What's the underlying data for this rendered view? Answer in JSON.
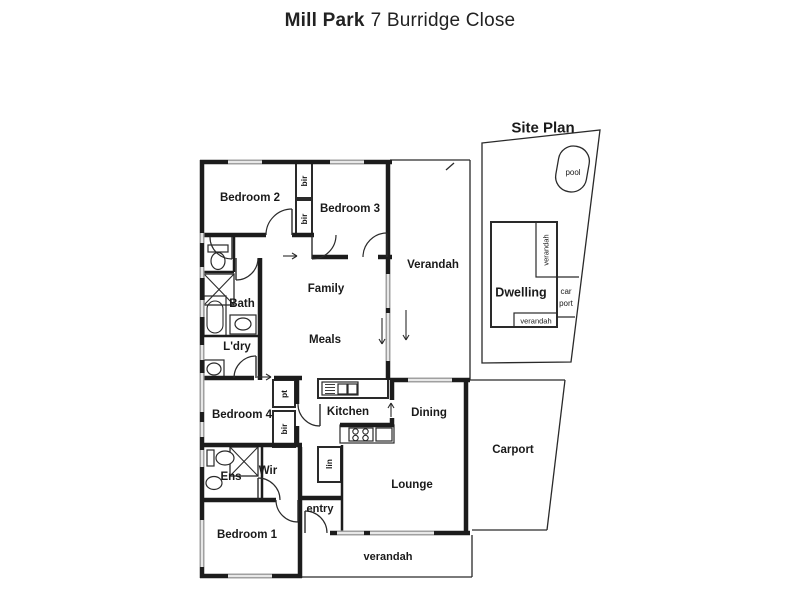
{
  "title": {
    "property": "Mill Park",
    "address": "7 Burridge Close"
  },
  "colors": {
    "wall": "#1c1c1c",
    "thin": "#2a2a2a",
    "window_glass": "#a0a0a0",
    "text": "#1a1a1a",
    "background": "#ffffff"
  },
  "floor_plan": {
    "room_labels": [
      {
        "t": "Bedroom 2",
        "x": 250,
        "y": 197,
        "s": 11.5,
        "w": 700
      },
      {
        "t": "Bedroom 3",
        "x": 350,
        "y": 208,
        "s": 11.5,
        "w": 700
      },
      {
        "t": "Verandah",
        "x": 433,
        "y": 264,
        "s": 11.5,
        "w": 700
      },
      {
        "t": "Family",
        "x": 326,
        "y": 288,
        "s": 11.5,
        "w": 700
      },
      {
        "t": "Meals",
        "x": 325,
        "y": 339,
        "s": 11.5,
        "w": 700
      },
      {
        "t": "Bath",
        "x": 242,
        "y": 303,
        "s": 11.5,
        "w": 700
      },
      {
        "t": "L'dry",
        "x": 237,
        "y": 346,
        "s": 11.5,
        "w": 700
      },
      {
        "t": "Bedroom 4",
        "x": 242,
        "y": 414,
        "s": 11.5,
        "w": 700
      },
      {
        "t": "Kitchen",
        "x": 348,
        "y": 411,
        "s": 11.5,
        "w": 700
      },
      {
        "t": "Dining",
        "x": 429,
        "y": 412,
        "s": 11.5,
        "w": 700
      },
      {
        "t": "Lounge",
        "x": 412,
        "y": 484,
        "s": 11.5,
        "w": 700
      },
      {
        "t": "Ens",
        "x": 231,
        "y": 476,
        "s": 11.5,
        "w": 700
      },
      {
        "t": "Wir",
        "x": 268,
        "y": 470,
        "s": 11.5,
        "w": 700
      },
      {
        "t": "Bedroom 1",
        "x": 247,
        "y": 534,
        "s": 11.5,
        "w": 700
      },
      {
        "t": "entry",
        "x": 320,
        "y": 508,
        "s": 11,
        "w": 700
      },
      {
        "t": "verandah",
        "x": 388,
        "y": 556,
        "s": 11,
        "w": 700
      },
      {
        "t": "Carport",
        "x": 513,
        "y": 449,
        "s": 11.5,
        "w": 700
      }
    ],
    "closet_labels": [
      {
        "t": "bir",
        "x": 304,
        "y": 181,
        "s": 8.5,
        "w": 700,
        "r": -90
      },
      {
        "t": "bir",
        "x": 304,
        "y": 219,
        "s": 8.5,
        "w": 700,
        "r": -90
      },
      {
        "t": "pt",
        "x": 284,
        "y": 394,
        "s": 8.5,
        "w": 700,
        "r": -90
      },
      {
        "t": "bir",
        "x": 284,
        "y": 429,
        "s": 8.5,
        "w": 700,
        "r": -90
      },
      {
        "t": "lin",
        "x": 329,
        "y": 464,
        "s": 8.5,
        "w": 700,
        "r": -90
      }
    ]
  },
  "site_plan": {
    "labels": [
      {
        "t": "Site Plan",
        "x": 543,
        "y": 127,
        "s": 15,
        "w": 700
      },
      {
        "t": "pool",
        "x": 573,
        "y": 172,
        "s": 8,
        "w": 400
      },
      {
        "t": "Dwelling",
        "x": 521,
        "y": 292,
        "s": 12.5,
        "w": 700
      },
      {
        "t": "verandah",
        "x": 546,
        "y": 250,
        "s": 7.5,
        "w": 400,
        "r": -90
      },
      {
        "t": "car",
        "x": 566,
        "y": 291,
        "s": 8,
        "w": 400
      },
      {
        "t": "port",
        "x": 566,
        "y": 303,
        "s": 8,
        "w": 400
      },
      {
        "t": "verandah",
        "x": 536,
        "y": 321,
        "s": 7.5,
        "w": 400
      }
    ],
    "boundary": [
      [
        482,
        143
      ],
      [
        600,
        130
      ],
      [
        571,
        362
      ],
      [
        482,
        363
      ]
    ],
    "dwelling_rect": [
      491,
      222,
      66,
      105
    ],
    "verandah_strip_right": [
      536,
      222,
      21,
      55
    ],
    "verandah_strip_bottom": [
      514,
      313,
      43,
      14
    ],
    "carport_lines": [
      [
        557,
        277,
        579,
        277
      ],
      [
        557,
        317,
        575,
        317
      ]
    ],
    "pool_shape": {
      "x": 557,
      "y": 146,
      "w": 31,
      "h": 46,
      "rx": 15,
      "rotate": 10
    }
  },
  "drawing": {
    "walls_thick": [
      [
        200,
        162,
        392,
        162
      ],
      [
        202,
        160,
        202,
        578
      ],
      [
        388,
        162,
        388,
        380
      ],
      [
        200,
        576,
        302,
        576
      ],
      [
        300,
        447,
        300,
        578
      ],
      [
        202,
        235,
        266,
        235
      ],
      [
        292,
        235,
        314,
        235
      ],
      [
        312,
        257,
        348,
        257
      ],
      [
        378,
        257,
        392,
        257
      ],
      [
        260,
        258,
        260,
        380
      ],
      [
        202,
        378,
        254,
        378
      ],
      [
        274,
        378,
        302,
        378
      ],
      [
        202,
        445,
        302,
        445
      ],
      [
        202,
        500,
        276,
        500
      ],
      [
        330,
        533,
        470,
        533
      ],
      [
        390,
        380,
        470,
        380
      ],
      [
        466,
        378,
        466,
        535
      ],
      [
        392,
        380,
        392,
        400
      ],
      [
        392,
        418,
        392,
        426
      ],
      [
        340,
        425,
        394,
        425
      ],
      [
        297,
        378,
        297,
        404
      ],
      [
        297,
        426,
        297,
        447
      ],
      [
        300,
        498,
        343,
        498
      ]
    ],
    "walls_medium": [
      [
        234,
        235,
        234,
        272
      ],
      [
        202,
        272,
        234,
        272
      ],
      [
        202,
        336,
        258,
        336
      ],
      [
        262,
        445,
        262,
        500
      ],
      [
        342,
        445,
        342,
        533
      ]
    ],
    "walls_thin": [
      [
        390,
        160,
        470,
        160
      ],
      [
        470,
        160,
        470,
        380
      ],
      [
        302,
        577,
        472,
        577
      ],
      [
        472,
        535,
        472,
        577
      ],
      [
        470,
        380,
        565,
        380
      ],
      [
        565,
        380,
        547,
        530
      ],
      [
        547,
        530,
        472,
        530
      ],
      [
        446,
        170,
        454,
        163
      ]
    ],
    "windows": [
      [
        228,
        162,
        262,
        162
      ],
      [
        330,
        162,
        364,
        162
      ],
      [
        202,
        233,
        202,
        243
      ],
      [
        202,
        267,
        202,
        278
      ],
      [
        202,
        300,
        202,
        317
      ],
      [
        202,
        345,
        202,
        360
      ],
      [
        202,
        373,
        202,
        412
      ],
      [
        202,
        422,
        202,
        437
      ],
      [
        202,
        450,
        202,
        467
      ],
      [
        202,
        520,
        202,
        567
      ],
      [
        228,
        576,
        272,
        576
      ],
      [
        337,
        533,
        364,
        533
      ],
      [
        370,
        533,
        434,
        533
      ],
      [
        388,
        274,
        388,
        308
      ],
      [
        388,
        313,
        388,
        361
      ],
      [
        408,
        380,
        452,
        380
      ]
    ],
    "boxes": [
      {
        "n": "bir-closet-1",
        "r": [
          296,
          163,
          16,
          35
        ],
        "sw": 2
      },
      {
        "n": "bir-closet-2",
        "r": [
          296,
          200,
          16,
          35
        ],
        "sw": 2
      },
      {
        "n": "pantry-closet",
        "r": [
          273,
          380,
          22,
          27
        ],
        "sw": 2
      },
      {
        "n": "bir-closet-3",
        "r": [
          273,
          411,
          22,
          36
        ],
        "sw": 2
      },
      {
        "n": "linen-closet",
        "r": [
          318,
          447,
          23,
          35
        ],
        "sw": 2
      },
      {
        "n": "kitchen-island",
        "r": [
          318,
          379,
          70,
          19
        ],
        "sw": 2
      },
      {
        "n": "kitchen-sink-unit",
        "r": [
          322,
          382,
          36,
          13
        ],
        "sw": 1.2
      },
      {
        "n": "sink-bowl-1",
        "r": [
          338,
          384,
          9,
          10
        ],
        "sw": 1.2
      },
      {
        "n": "sink-bowl-2",
        "r": [
          348,
          384,
          9,
          10
        ],
        "sw": 1.2
      },
      {
        "n": "cooktop-counter",
        "r": [
          340,
          425,
          54,
          18
        ],
        "sw": 1.2
      },
      {
        "n": "cooktop-box",
        "r": [
          349,
          428,
          24,
          13
        ],
        "sw": 1.2
      },
      {
        "n": "counter-box",
        "r": [
          376,
          428,
          16,
          13
        ],
        "sw": 1.2
      },
      {
        "n": "wc-cistern",
        "r": [
          208,
          245,
          20,
          7
        ],
        "sw": 1.2
      },
      {
        "n": "bath-vanity",
        "r": [
          230,
          315,
          26,
          19
        ],
        "sw": 1.2
      },
      {
        "n": "laundry-trough",
        "r": [
          204,
          360,
          20,
          18
        ],
        "sw": 1.2
      },
      {
        "n": "ens-cistern",
        "r": [
          207,
          450,
          7,
          16
        ],
        "sw": 1.2
      },
      {
        "n": "bathtub-outer",
        "r": [
          204,
          296,
          22,
          40
        ],
        "sw": 1.2
      }
    ],
    "rrects": [
      {
        "n": "bathtub-inner",
        "r": [
          207,
          301,
          16,
          32
        ],
        "rx": 8,
        "sw": 1.1
      }
    ],
    "xboxes": [
      {
        "n": "shower-bath",
        "r": [
          204,
          274,
          30,
          31
        ]
      },
      {
        "n": "shower-ens",
        "r": [
          230,
          447,
          28,
          29
        ]
      }
    ],
    "ellipses": [
      {
        "n": "wc-toilet-bowl",
        "c": [
          218,
          261,
          7,
          8.5
        ]
      },
      {
        "n": "vanity-basin",
        "c": [
          243,
          324,
          8,
          6
        ]
      },
      {
        "n": "trough-basin",
        "c": [
          214,
          369,
          7,
          6
        ]
      },
      {
        "n": "ens-toilet-bowl",
        "c": [
          225,
          458,
          9,
          7
        ]
      },
      {
        "n": "ens-basin",
        "c": [
          214,
          483,
          8,
          6.5
        ]
      }
    ],
    "cooktop_circles": [
      [
        355.5,
        431.5
      ],
      [
        365.5,
        431.5
      ],
      [
        355.5,
        438
      ],
      [
        365.5,
        438
      ]
    ],
    "hatch_lines": [
      [
        325,
        384.5,
        335,
        384.5
      ],
      [
        325,
        387.5,
        335,
        387.5
      ],
      [
        325,
        390.5,
        335,
        390.5
      ],
      [
        325,
        393.5,
        335,
        393.5
      ]
    ],
    "doors": [
      {
        "n": "door-bedroom2",
        "p": "M266,235 A26,26 0 0 1 292,209",
        "l": [
          292,
          235,
          292,
          209
        ]
      },
      {
        "n": "door-bedroom3",
        "p": "M363,257 A24,24 0 0 1 387,233",
        "l": [
          387,
          257,
          387,
          233
        ]
      },
      {
        "n": "door-hall",
        "p": "M336,235 A24,24 0 0 1 312,259",
        "l": [
          312,
          235,
          312,
          259
        ]
      },
      {
        "n": "door-wc",
        "p": "M210,237 A22,22 0 0 0 232,259",
        "l": [
          232,
          237,
          232,
          259
        ]
      },
      {
        "n": "door-bath",
        "p": "M258,258 A22,22 0 0 1 236,280",
        "l": [
          236,
          258,
          236,
          280
        ]
      },
      {
        "n": "door-laundry",
        "p": "M234,378 A22,22 0 0 1 256,356",
        "l": [
          256,
          378,
          256,
          356
        ]
      },
      {
        "n": "door-kitchen",
        "p": "M298,404 A22,22 0 0 0 320,426",
        "l": [
          320,
          404,
          320,
          426
        ]
      },
      {
        "n": "door-wir",
        "p": "M280,500 A22,22 0 0 0 258,478",
        "l": [
          258,
          500,
          258,
          478
        ]
      },
      {
        "n": "door-bedroom1",
        "p": "M276,500 A22,22 0 0 0 298,522",
        "l": [
          298,
          500,
          298,
          522
        ]
      },
      {
        "n": "door-entry",
        "p": "M327,533 A22,22 0 0 0 305,511",
        "l": [
          305,
          533,
          305,
          511
        ]
      }
    ],
    "arrows": [
      [
        283,
        256,
        297,
        256
      ],
      [
        257,
        377,
        271,
        377
      ],
      [
        382,
        318,
        382,
        344
      ],
      [
        406,
        310,
        406,
        340
      ],
      [
        391,
        417,
        391,
        403
      ]
    ]
  }
}
